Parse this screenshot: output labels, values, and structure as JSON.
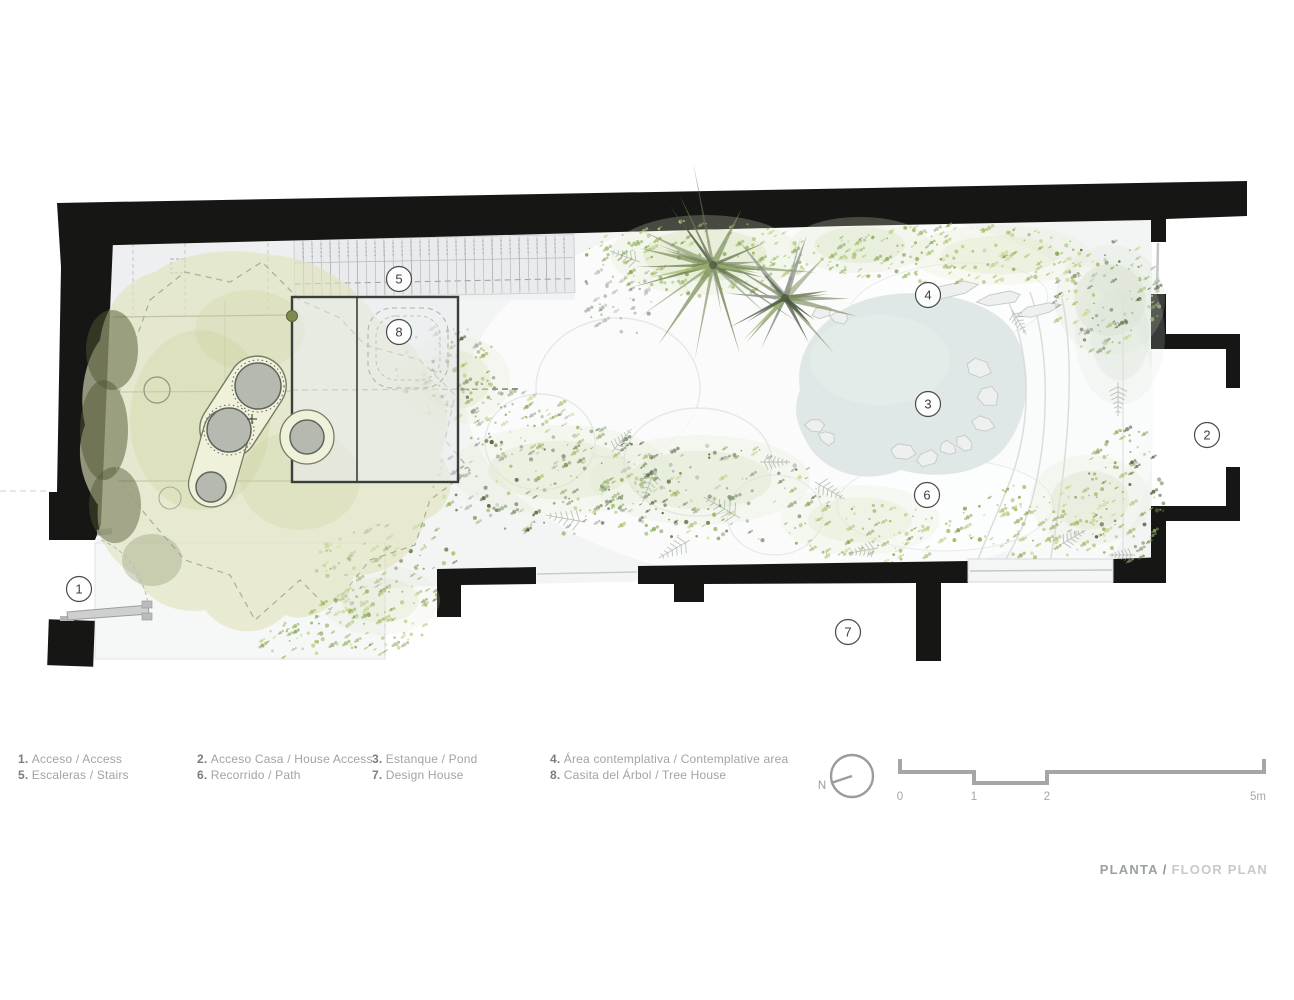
{
  "plan": {
    "markers": [
      {
        "num": "1",
        "name": "Acceso / Access"
      },
      {
        "num": "2",
        "name": "Acceso Casa / House Access"
      },
      {
        "num": "3",
        "name": "Estanque / Pond"
      },
      {
        "num": "4",
        "name": "Área contemplativa / Contemplative area"
      },
      {
        "num": "5",
        "name": "Escaleras / Stairs"
      },
      {
        "num": "6",
        "name": "Recorrido / Path"
      },
      {
        "num": "7",
        "name": "Design House"
      },
      {
        "num": "8",
        "name": "Casita del Árbol / Tree House"
      }
    ]
  },
  "legend": {
    "items": [
      {
        "num": "1.",
        "label": "Acceso / Access"
      },
      {
        "num": "2.",
        "label": "Acceso Casa / House Access"
      },
      {
        "num": "3.",
        "label": "Estanque / Pond"
      },
      {
        "num": "4.",
        "label": "Área contemplativa / Contemplative area"
      },
      {
        "num": "5.",
        "label": "Escaleras / Stairs"
      },
      {
        "num": "6.",
        "label": "Recorrido / Path"
      },
      {
        "num": "7.",
        "label": "Design House"
      },
      {
        "num": "8.",
        "label": "Casita del Árbol / Tree House"
      }
    ]
  },
  "north": {
    "label": "N"
  },
  "scale_bar": {
    "ticks": [
      "0",
      "1",
      "2",
      "5m"
    ]
  },
  "caption": {
    "primary": "PLANTA",
    "separator": "/",
    "secondary": "FLOOR PLAN"
  },
  "colors": {
    "wall": "#161615",
    "canopy": "#dfe3ba",
    "pond": "#dce5e4",
    "foliage_light": "#a9c271",
    "foliage_dark": "#5f7448",
    "trunk": "#b6b9af",
    "annotation_gray": "#a6a6a6"
  }
}
